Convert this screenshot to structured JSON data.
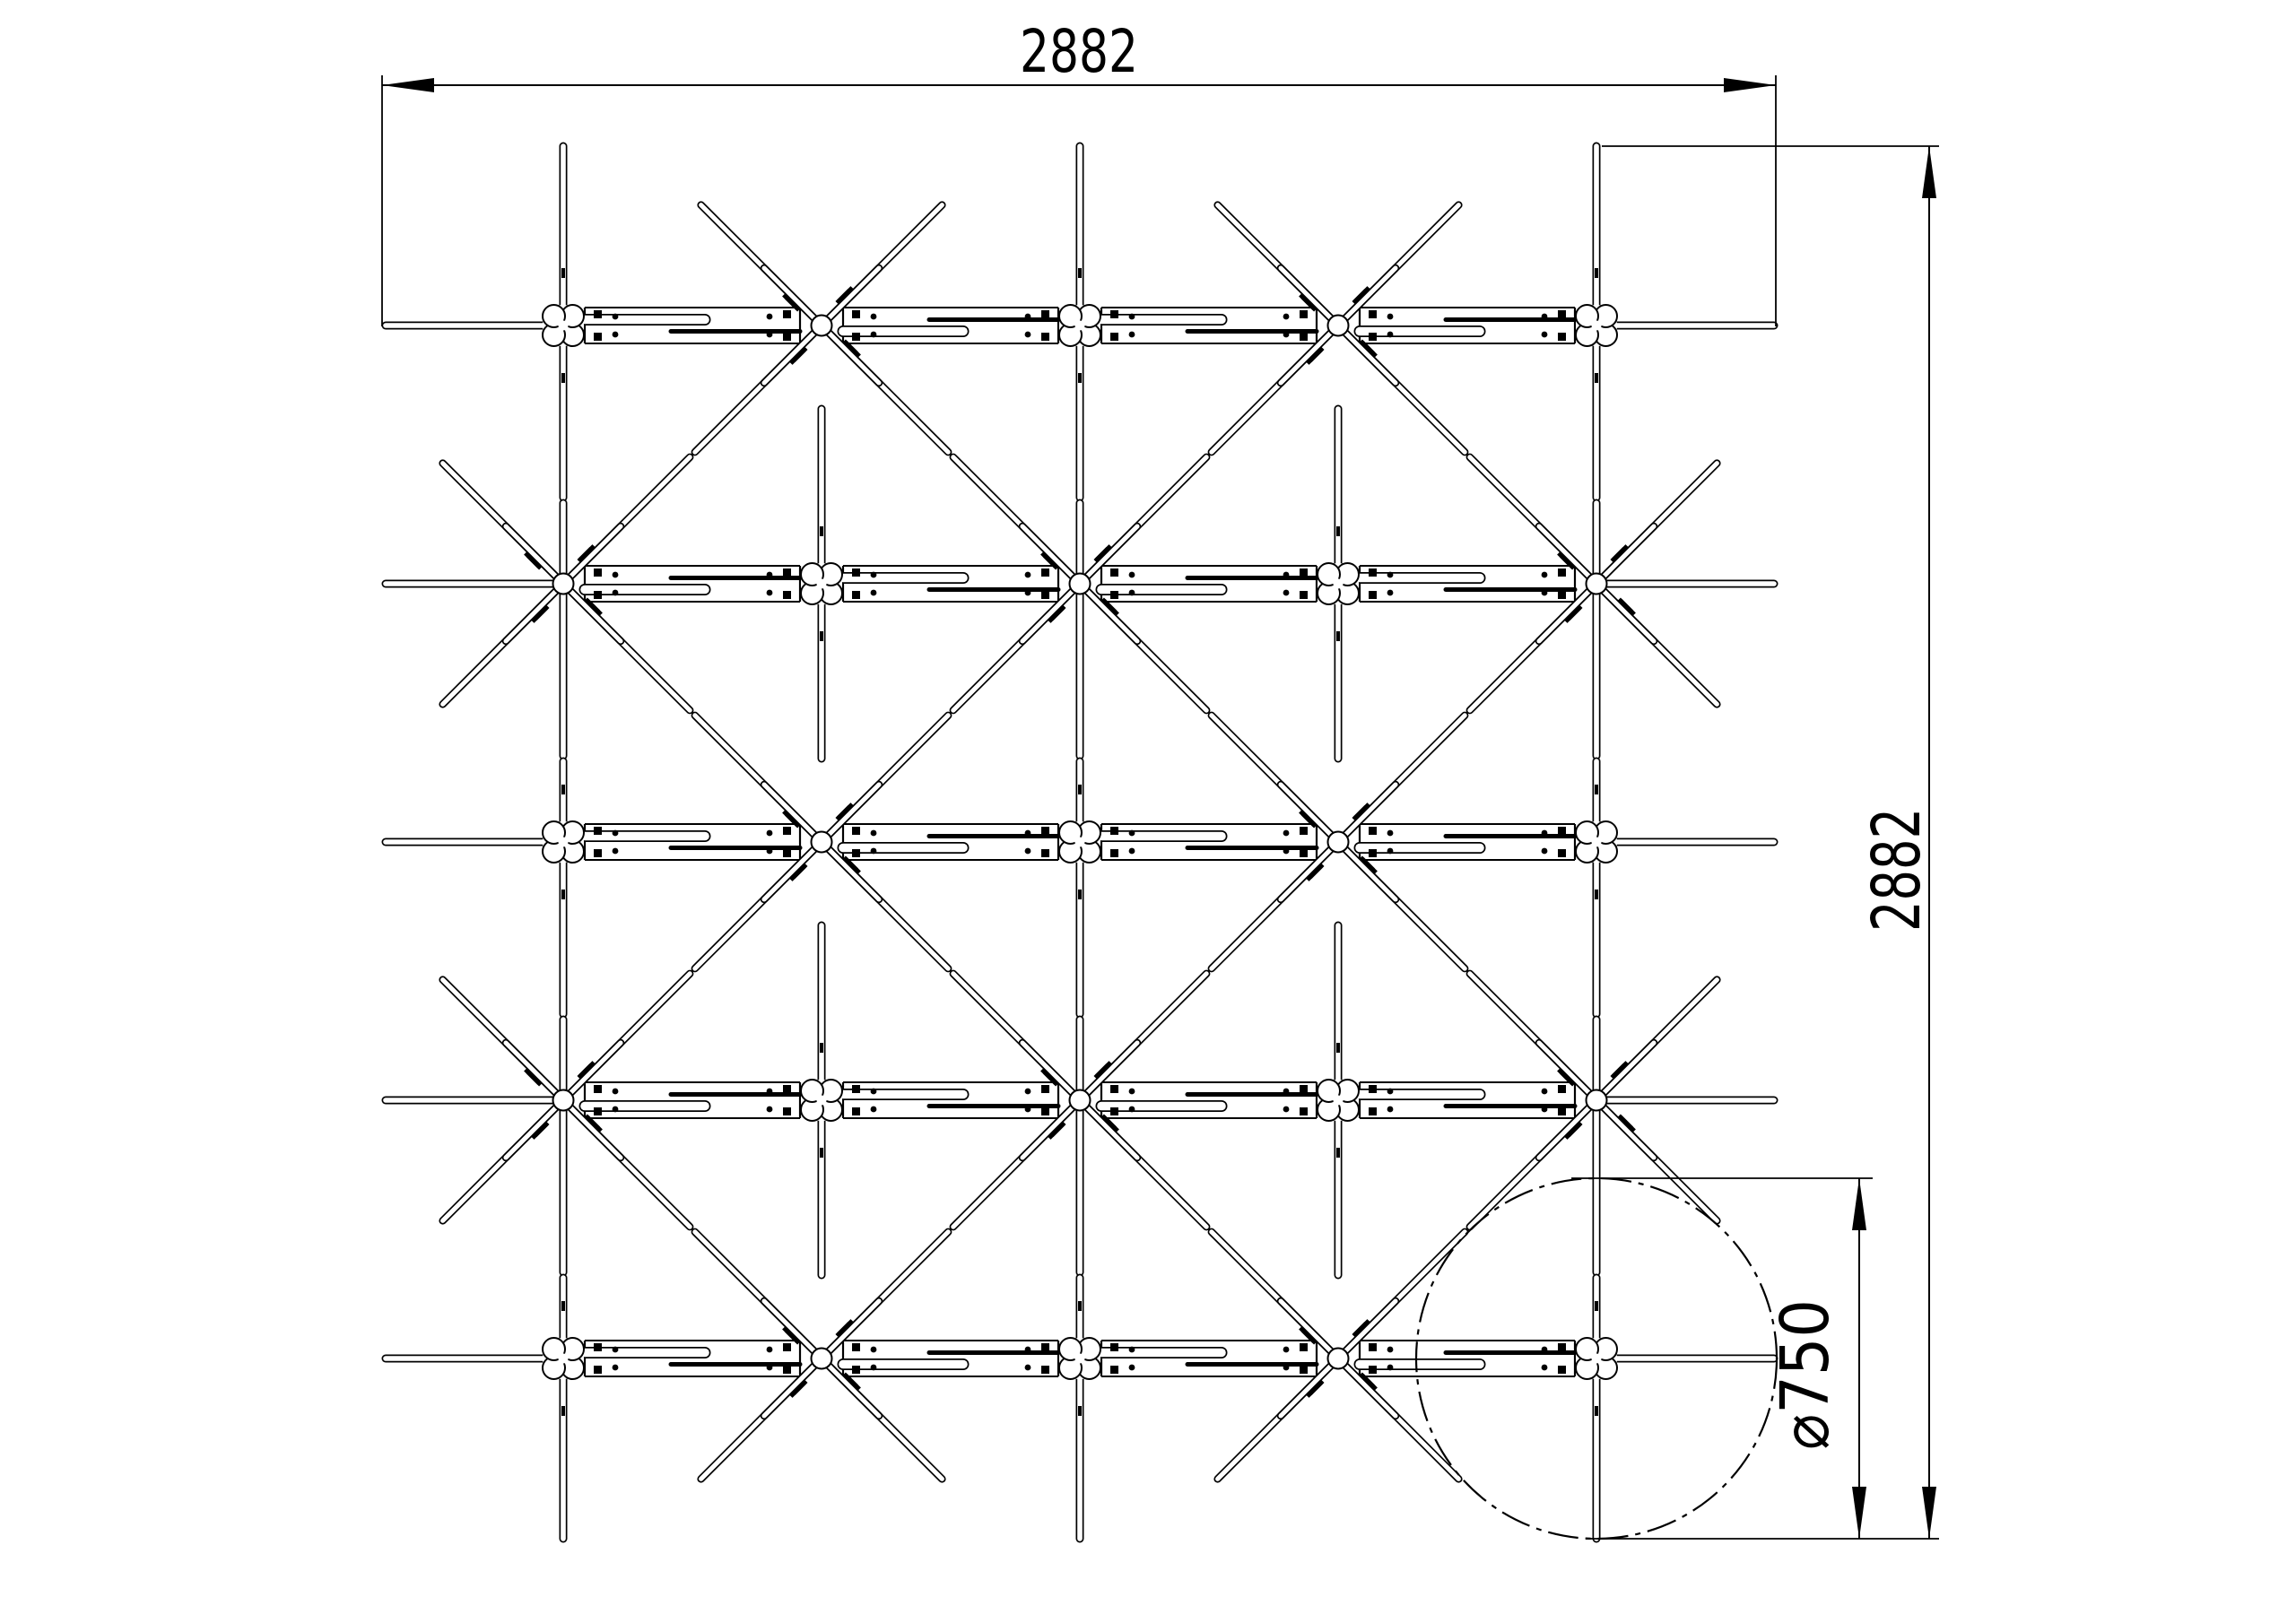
{
  "drawing": {
    "background": "#ffffff",
    "line_color": "#000000",
    "dimensions": {
      "overall_width": {
        "value": "2882"
      },
      "overall_height": {
        "value": "2882"
      },
      "detail_diameter": {
        "value": "⌀750"
      }
    },
    "structure": {
      "grid_columns": 5,
      "grid_rows": 5,
      "joint_types": [
        "clamp-cross-joint",
        "diagonal-crossing-joint"
      ],
      "detail_circle_style": "dash-dot"
    }
  }
}
